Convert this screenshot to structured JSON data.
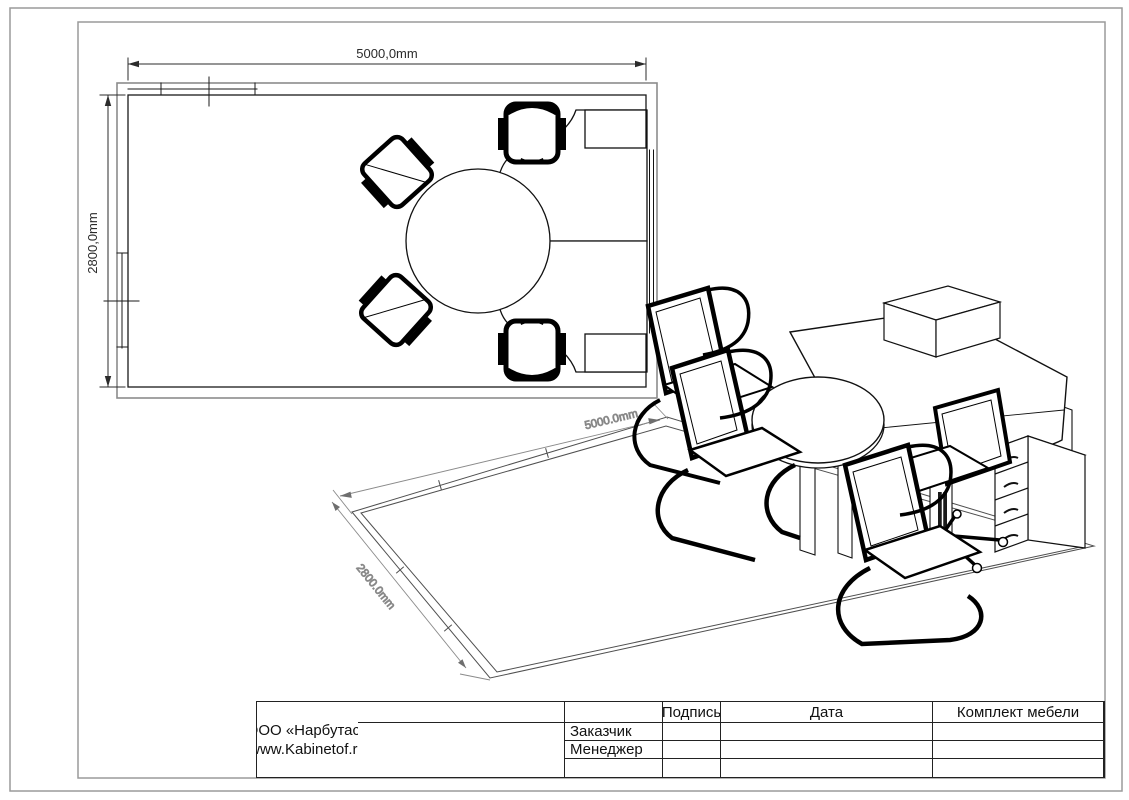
{
  "sheet": {
    "background": "#ffffff",
    "frame_color": "#9a9a9a",
    "ink": "#111111",
    "wall_outer_color": "#8c8c8c"
  },
  "plan_view": {
    "width_dim_label": "5000,0mm",
    "height_dim_label": "2800,0mm"
  },
  "iso_view": {
    "width_dim_label": "5000.0mm",
    "depth_dim_label": "2800.0mm"
  },
  "title_block": {
    "col_signature": "Подпись",
    "col_date": "Дата",
    "project_title": "Комплект мебели",
    "row_customer": "Заказчик",
    "row_manager": "Менеджер",
    "company_name": "ООО «Нарбутас»",
    "company_site": "www.Kabinetof.ru"
  }
}
